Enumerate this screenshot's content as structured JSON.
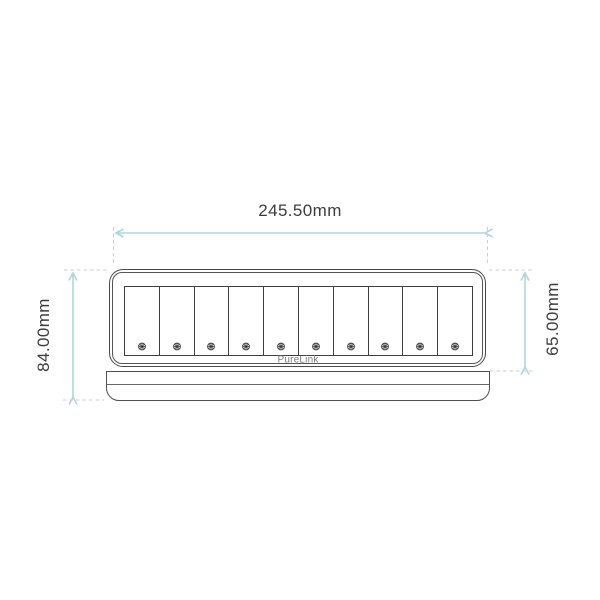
{
  "drawing": {
    "type": "technical-dimension-drawing",
    "view": "front"
  },
  "dimensions": {
    "width": {
      "label": "245.50mm"
    },
    "height_overall": {
      "label": "84.00mm"
    },
    "height_body": {
      "label": "65.00mm"
    }
  },
  "device": {
    "brand": "PureLink",
    "slot_count": 10,
    "slot_icon": "screw-icon"
  },
  "colors": {
    "dimension_arrow": "#afd5db",
    "extension_line": "#cccccc",
    "outline": "#4a4a4a",
    "label_text": "#3c3c3c",
    "brand_text": "#7a7a7a"
  }
}
